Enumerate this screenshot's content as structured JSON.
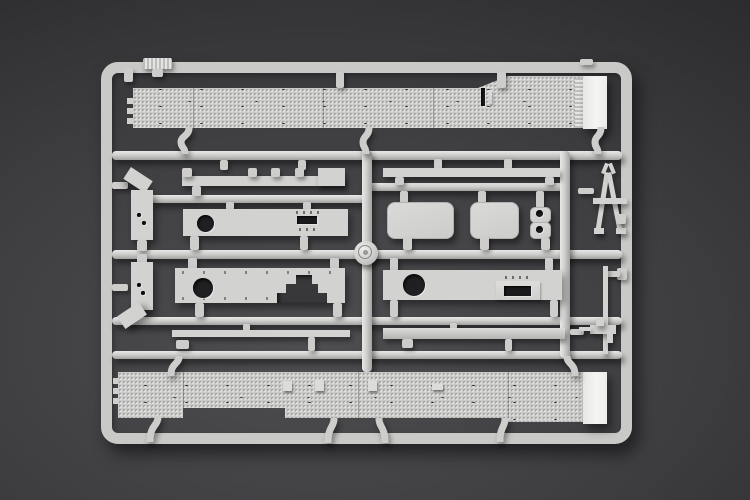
{
  "photo": {
    "subject": "gray injection-molded plastic model kit sprue (parts tree) photographed on a dark gray studio background",
    "visible_text": "",
    "colors": {
      "background_center": "#4e4e51",
      "background_edge": "#212123",
      "plastic_base": "#d2d2d0",
      "plastic_highlight": "#e8e8e6",
      "plastic_shadow": "#a2a2a0",
      "treadplate_deck": "#cbcbc9",
      "white_end_cap": "#f5f5f3",
      "through_hole": "#202022"
    },
    "parts": [
      {
        "name": "sprue-frame",
        "shape": "rounded rectangle runner frame"
      },
      {
        "name": "upper-treadplate-deck",
        "shape": "long textured deck part with white end cap"
      },
      {
        "name": "lower-treadplate-deck",
        "shape": "long textured deck part with white end cap"
      },
      {
        "name": "toothed-rail",
        "shape": "long rail with upward teeth"
      },
      {
        "name": "side-sill-bar",
        "shape": "long plain bar"
      },
      {
        "name": "fender-plate-left",
        "shape": "plate with round hole and rectangular slot"
      },
      {
        "name": "stepped-hull-plate",
        "shape": "plate with round hole and stair-step cutout"
      },
      {
        "name": "fender-plate-right",
        "shape": "plate with round hole and recessed slot panel"
      },
      {
        "name": "hatch-cover-large",
        "shape": "rounded rectangle hatch"
      },
      {
        "name": "hatch-cover-small",
        "shape": "rounded rectangle hatch"
      },
      {
        "name": "lamp-pad-pair",
        "shape": "two small pads with round holes"
      },
      {
        "name": "a-frame-tow-bar",
        "shape": "A-shaped frame part"
      },
      {
        "name": "machine-gun",
        "shape": "small gun body with barrel"
      },
      {
        "name": "barrel-rod",
        "shape": "long thin vertical rod"
      },
      {
        "name": "mud-flap-upper",
        "shape": "angled bracket part"
      },
      {
        "name": "mud-flap-lower",
        "shape": "angled bracket part"
      },
      {
        "name": "thin-strip",
        "shape": "long thin strip"
      },
      {
        "name": "channel-strip",
        "shape": "long channel strip"
      },
      {
        "name": "logo-medallion",
        "shape": "round embossed maker medallion at runner crossing"
      },
      {
        "name": "ribbed-molding-tag",
        "shape": "small ribbed tag on top frame"
      },
      {
        "name": "sprue-letter-tab",
        "shape": "small identification tab on frame corner"
      }
    ]
  }
}
